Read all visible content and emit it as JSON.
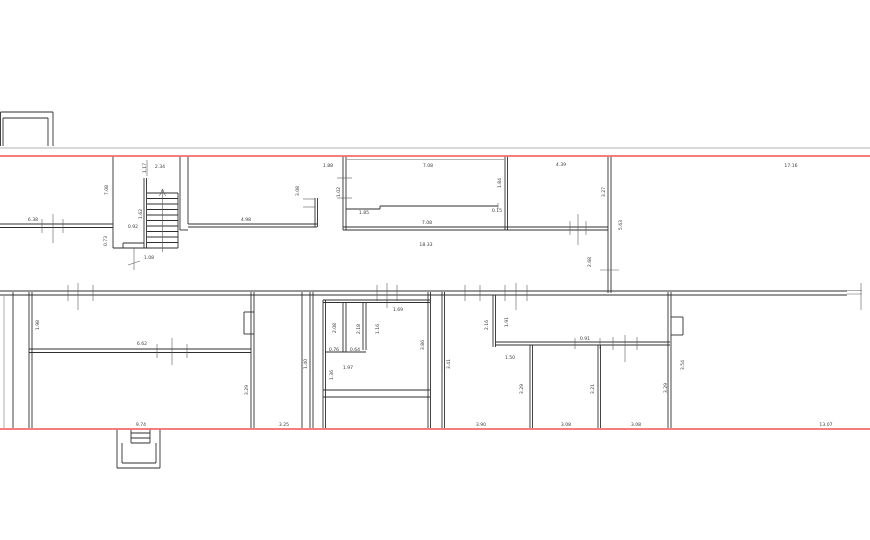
{
  "plan": {
    "width": 870,
    "height": 540,
    "colors": {
      "background": "#ffffff",
      "wall": "#2f2f2f",
      "thin": "#9a9a9a",
      "dim": "#5a5a5a",
      "red": "#f26d6d",
      "text": "#3a3a3a"
    },
    "red_lines": [
      [
        0,
        156,
        870,
        156
      ],
      [
        0,
        429,
        870,
        429
      ]
    ],
    "walls": [
      [
        0.5,
        112,
        0.5,
        146
      ],
      [
        0.5,
        112,
        53,
        112
      ],
      [
        53,
        112,
        53,
        146
      ],
      [
        3,
        118,
        48,
        118
      ],
      [
        48,
        118,
        48,
        146
      ],
      [
        3,
        118,
        3,
        146
      ],
      [
        0,
        148,
        870,
        148,
        "t"
      ],
      [
        0,
        224,
        113,
        224
      ],
      [
        0,
        227.5,
        113,
        227.5
      ],
      [
        42,
        219,
        42,
        233,
        "d"
      ],
      [
        63,
        219,
        63,
        233,
        "d"
      ],
      [
        53,
        214,
        53,
        243,
        "d"
      ],
      [
        113,
        156,
        113,
        248
      ],
      [
        144,
        178,
        144,
        248
      ],
      [
        146.5,
        178,
        146.5,
        248
      ],
      [
        147,
        160,
        147,
        176,
        "d"
      ],
      [
        147,
        193,
        178,
        193
      ],
      [
        147,
        198.5,
        178,
        198.5
      ],
      [
        147,
        204,
        178,
        204
      ],
      [
        147,
        209.5,
        178,
        209.5
      ],
      [
        147,
        215,
        178,
        215
      ],
      [
        147,
        220.5,
        178,
        220.5
      ],
      [
        147,
        226,
        178,
        226
      ],
      [
        147,
        231.5,
        178,
        231.5
      ],
      [
        147,
        237,
        178,
        237
      ],
      [
        147,
        242.5,
        178,
        242.5
      ],
      [
        178,
        193,
        178,
        248
      ],
      [
        113,
        248,
        178,
        248
      ],
      [
        123,
        243,
        144,
        243
      ],
      [
        123,
        243,
        123,
        248
      ],
      [
        162.5,
        189,
        162.5,
        252,
        "d"
      ],
      [
        159.5,
        196,
        162.5,
        189,
        "d"
      ],
      [
        165.5,
        196,
        162.5,
        189,
        "d"
      ],
      [
        134,
        248,
        134,
        270,
        "d"
      ],
      [
        128,
        265,
        140,
        261,
        "d"
      ],
      [
        180,
        156,
        180,
        230
      ],
      [
        180,
        230,
        188,
        230
      ],
      [
        188,
        156,
        188,
        224
      ],
      [
        188,
        224,
        317,
        224
      ],
      [
        188,
        227,
        317,
        227
      ],
      [
        315,
        198,
        315,
        227
      ],
      [
        317.5,
        198,
        317.5,
        227
      ],
      [
        303,
        199,
        315,
        199,
        "d"
      ],
      [
        303,
        207,
        315,
        207,
        "d"
      ],
      [
        343,
        156,
        343,
        230
      ],
      [
        346,
        156,
        346,
        230
      ],
      [
        343,
        227,
        507,
        227
      ],
      [
        343,
        230,
        507,
        230
      ],
      [
        505,
        156,
        505,
        230
      ],
      [
        507.5,
        156,
        507.5,
        230
      ],
      [
        346,
        159.5,
        505,
        159.5,
        "t"
      ],
      [
        337,
        178,
        352,
        178,
        "d"
      ],
      [
        337,
        198,
        352,
        198,
        "d"
      ],
      [
        346,
        209,
        380,
        209
      ],
      [
        380,
        206,
        380,
        209
      ],
      [
        380,
        206,
        498,
        206
      ],
      [
        498,
        203,
        498,
        209,
        "d"
      ],
      [
        507,
        227,
        608,
        227
      ],
      [
        507,
        230,
        608,
        230
      ],
      [
        570,
        221,
        570,
        235,
        "d"
      ],
      [
        586,
        221,
        586,
        235,
        "d"
      ],
      [
        578,
        214,
        578,
        245,
        "d"
      ],
      [
        608,
        156,
        608,
        293
      ],
      [
        611,
        156,
        611,
        293
      ],
      [
        600,
        270,
        619,
        270,
        "d"
      ],
      [
        0,
        291,
        847,
        291
      ],
      [
        0,
        295,
        847,
        295
      ],
      [
        68,
        285,
        68,
        301,
        "d"
      ],
      [
        93,
        285,
        93,
        301,
        "d"
      ],
      [
        78,
        283,
        78,
        310,
        "d"
      ],
      [
        377,
        285,
        377,
        301,
        "d"
      ],
      [
        397,
        285,
        397,
        301,
        "d"
      ],
      [
        387,
        283,
        387,
        308,
        "d"
      ],
      [
        465,
        285,
        465,
        301,
        "d"
      ],
      [
        480,
        285,
        480,
        301,
        "d"
      ],
      [
        505,
        285,
        505,
        301,
        "d"
      ],
      [
        527,
        285,
        527,
        301,
        "d"
      ],
      [
        516,
        283,
        516,
        310,
        "d"
      ],
      [
        847,
        290.5,
        862,
        290.5,
        "t"
      ],
      [
        847,
        294,
        862,
        294,
        "t"
      ],
      [
        861,
        283,
        861,
        310,
        "d"
      ],
      [
        4,
        295,
        4,
        428,
        "t"
      ],
      [
        13,
        292,
        13,
        428
      ],
      [
        29,
        292,
        29,
        428
      ],
      [
        32,
        292,
        32,
        428
      ],
      [
        29,
        349,
        251,
        349
      ],
      [
        29,
        352.5,
        251,
        352.5
      ],
      [
        157,
        344,
        157,
        358,
        "d"
      ],
      [
        187,
        344,
        187,
        358,
        "d"
      ],
      [
        172,
        338,
        172,
        365,
        "d"
      ],
      [
        251,
        292,
        251,
        428
      ],
      [
        254,
        292,
        254,
        428
      ],
      [
        244,
        312,
        254,
        312
      ],
      [
        244,
        334,
        254,
        334
      ],
      [
        244,
        312,
        244,
        334
      ],
      [
        302,
        292,
        302,
        428
      ],
      [
        310,
        292,
        310,
        428
      ],
      [
        313,
        292,
        313,
        428
      ],
      [
        323,
        300,
        323,
        428
      ],
      [
        325.5,
        300,
        325.5,
        428
      ],
      [
        323,
        300,
        430,
        300
      ],
      [
        323,
        302.5,
        430,
        302.5
      ],
      [
        428,
        292,
        428,
        428
      ],
      [
        430.5,
        292,
        430.5,
        428
      ],
      [
        343,
        302,
        343,
        352
      ],
      [
        346,
        302,
        346,
        352
      ],
      [
        363,
        302,
        363,
        350
      ],
      [
        366,
        302,
        366,
        350
      ],
      [
        325,
        352,
        366,
        352
      ],
      [
        323,
        390,
        430,
        390
      ],
      [
        323,
        397,
        430,
        397
      ],
      [
        442,
        292,
        442,
        428
      ],
      [
        444.5,
        292,
        444.5,
        428
      ],
      [
        493,
        295,
        493,
        347
      ],
      [
        495.5,
        295,
        495.5,
        347
      ],
      [
        495,
        342,
        670,
        342
      ],
      [
        495,
        345,
        670,
        345
      ],
      [
        625,
        335,
        625,
        362,
        "d"
      ],
      [
        613,
        337,
        613,
        350,
        "d"
      ],
      [
        637,
        337,
        637,
        350,
        "d"
      ],
      [
        575,
        338,
        575,
        349,
        "d"
      ],
      [
        600,
        338,
        600,
        349,
        "d"
      ],
      [
        530,
        345,
        530,
        428
      ],
      [
        532.5,
        345,
        532.5,
        428
      ],
      [
        598,
        345,
        598,
        428
      ],
      [
        600.5,
        345,
        600.5,
        428
      ],
      [
        668,
        292,
        668,
        428
      ],
      [
        671,
        292,
        671,
        428
      ],
      [
        671,
        317,
        683,
        317
      ],
      [
        671,
        335,
        683,
        335
      ],
      [
        683,
        317,
        683,
        335
      ],
      [
        117,
        429,
        117,
        468
      ],
      [
        160,
        429,
        160,
        468
      ],
      [
        117,
        468,
        160,
        468
      ],
      [
        122,
        443,
        122,
        463
      ],
      [
        122,
        463,
        156,
        463
      ],
      [
        156,
        443,
        156,
        463
      ],
      [
        131,
        429,
        131,
        443
      ],
      [
        150,
        429,
        150,
        443
      ],
      [
        131,
        433,
        150,
        433
      ],
      [
        131,
        438,
        150,
        438
      ],
      [
        131,
        443,
        150,
        443
      ]
    ],
    "labels": [
      {
        "t": "2.34",
        "x": 160,
        "y": 168
      },
      {
        "t": "1.17",
        "x": 146,
        "y": 168,
        "v": 1
      },
      {
        "t": "7.08",
        "x": 108,
        "y": 190,
        "v": 1
      },
      {
        "t": "6.38",
        "x": 33,
        "y": 221
      },
      {
        "t": "0.92",
        "x": 133,
        "y": 228
      },
      {
        "t": "1.62",
        "x": 142,
        "y": 214,
        "v": 1
      },
      {
        "t": "0.73",
        "x": 107,
        "y": 241,
        "v": 1
      },
      {
        "t": "1.08",
        "x": 149,
        "y": 259
      },
      {
        "t": "4.98",
        "x": 246,
        "y": 221
      },
      {
        "t": "3.08",
        "x": 299,
        "y": 191,
        "v": 1
      },
      {
        "t": "1.88",
        "x": 328,
        "y": 167
      },
      {
        "t": "1.02",
        "x": 340,
        "y": 192,
        "v": 1
      },
      {
        "t": "7.08",
        "x": 428,
        "y": 167
      },
      {
        "t": "1.85",
        "x": 364,
        "y": 214
      },
      {
        "t": "0.15",
        "x": 497,
        "y": 212
      },
      {
        "t": "1.84",
        "x": 501,
        "y": 183,
        "v": 1
      },
      {
        "t": "7.08",
        "x": 427,
        "y": 224
      },
      {
        "t": "18.33",
        "x": 426,
        "y": 246
      },
      {
        "t": "4.39",
        "x": 561,
        "y": 166
      },
      {
        "t": "3.27",
        "x": 605,
        "y": 192,
        "v": 1
      },
      {
        "t": "5.63",
        "x": 622,
        "y": 225,
        "v": 1
      },
      {
        "t": "2.68",
        "x": 591,
        "y": 262,
        "v": 1
      },
      {
        "t": "17.16",
        "x": 791,
        "y": 167
      },
      {
        "t": "1.98",
        "x": 39,
        "y": 325,
        "v": 1
      },
      {
        "t": "6.62",
        "x": 142,
        "y": 345
      },
      {
        "t": "3.29",
        "x": 248,
        "y": 390,
        "v": 1
      },
      {
        "t": "9.74",
        "x": 141,
        "y": 426
      },
      {
        "t": "3.25",
        "x": 284,
        "y": 426
      },
      {
        "t": "1.40",
        "x": 307,
        "y": 364,
        "v": 1
      },
      {
        "t": "2.08",
        "x": 336,
        "y": 328,
        "v": 1
      },
      {
        "t": "2.18",
        "x": 360,
        "y": 329,
        "v": 1
      },
      {
        "t": "1.16",
        "x": 379,
        "y": 329,
        "v": 1
      },
      {
        "t": "1.69",
        "x": 398,
        "y": 311
      },
      {
        "t": "0.76",
        "x": 334,
        "y": 351
      },
      {
        "t": "0.64",
        "x": 355,
        "y": 351
      },
      {
        "t": "1.97",
        "x": 348,
        "y": 369
      },
      {
        "t": "1.36",
        "x": 333,
        "y": 375,
        "v": 1
      },
      {
        "t": "3.86",
        "x": 424,
        "y": 345,
        "v": 1
      },
      {
        "t": "3.41",
        "x": 450,
        "y": 364,
        "v": 1
      },
      {
        "t": "2.16",
        "x": 488,
        "y": 325,
        "v": 1
      },
      {
        "t": "1.91",
        "x": 508,
        "y": 322,
        "v": 1
      },
      {
        "t": "0.91",
        "x": 585,
        "y": 340
      },
      {
        "t": "1.50",
        "x": 510,
        "y": 359
      },
      {
        "t": "3.29",
        "x": 523,
        "y": 389,
        "v": 1
      },
      {
        "t": "3.21",
        "x": 594,
        "y": 389,
        "v": 1
      },
      {
        "t": "3.29",
        "x": 667,
        "y": 388,
        "v": 1
      },
      {
        "t": "3.54",
        "x": 684,
        "y": 365,
        "v": 1
      },
      {
        "t": "3.90",
        "x": 481,
        "y": 426
      },
      {
        "t": "3.08",
        "x": 566,
        "y": 426
      },
      {
        "t": "3.08",
        "x": 636,
        "y": 426
      },
      {
        "t": "13.07",
        "x": 826,
        "y": 426
      }
    ]
  }
}
